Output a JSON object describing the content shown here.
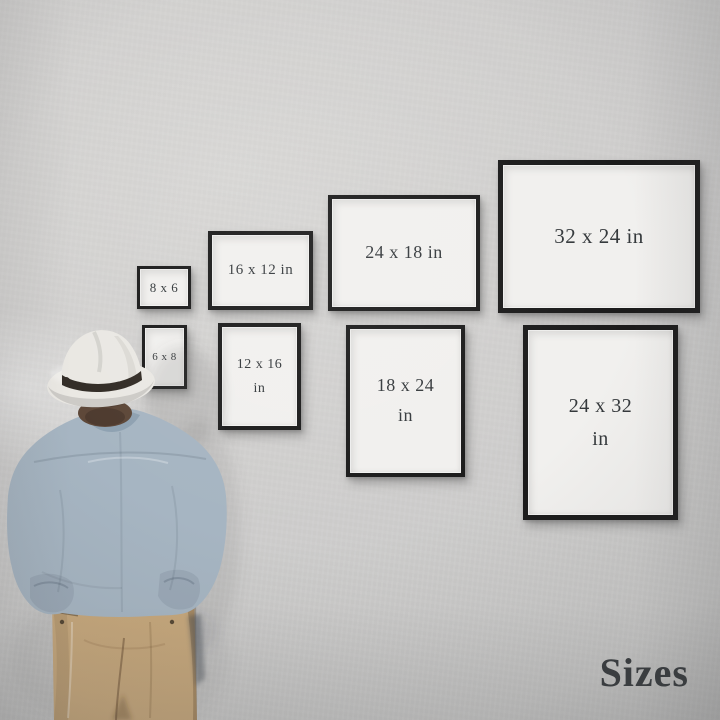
{
  "caption": "Sizes",
  "frames": [
    {
      "label": "8 x 6",
      "orientation": "landscape",
      "lines": [
        "8 x 6",
        ""
      ]
    },
    {
      "label": "16 x 12 in",
      "orientation": "landscape",
      "lines": [
        "16 x 12 in",
        ""
      ]
    },
    {
      "label": "24 x 18 in",
      "orientation": "landscape",
      "lines": [
        "24 x 18 in",
        ""
      ]
    },
    {
      "label": "32 x 24 in",
      "orientation": "landscape",
      "lines": [
        "32 x 24 in",
        ""
      ]
    },
    {
      "label": "6 x 8",
      "orientation": "portrait",
      "lines": [
        "6 x 8",
        ""
      ]
    },
    {
      "label": "12 x 16 in",
      "orientation": "portrait",
      "lines": [
        "12 x 16",
        "in"
      ]
    },
    {
      "label": "18 x 24 in",
      "orientation": "portrait",
      "lines": [
        "18 x 24",
        "in"
      ]
    },
    {
      "label": "24 x 32 in",
      "orientation": "portrait",
      "lines": [
        "24 x 32",
        "in"
      ]
    }
  ],
  "colors": {
    "wall": "#d1d0cf",
    "frame_border": "#1b1b1b",
    "frame_face": "#f1f0ee",
    "label_text": "#35393c",
    "caption_text": "#3a3d40",
    "hat": "#eae8e3",
    "hat_band": "#322c26",
    "hair": "#5d4738",
    "shirt": "#a6b5c2",
    "shirt_shade": "#8ea1b1",
    "pants": "#c7a87c"
  }
}
